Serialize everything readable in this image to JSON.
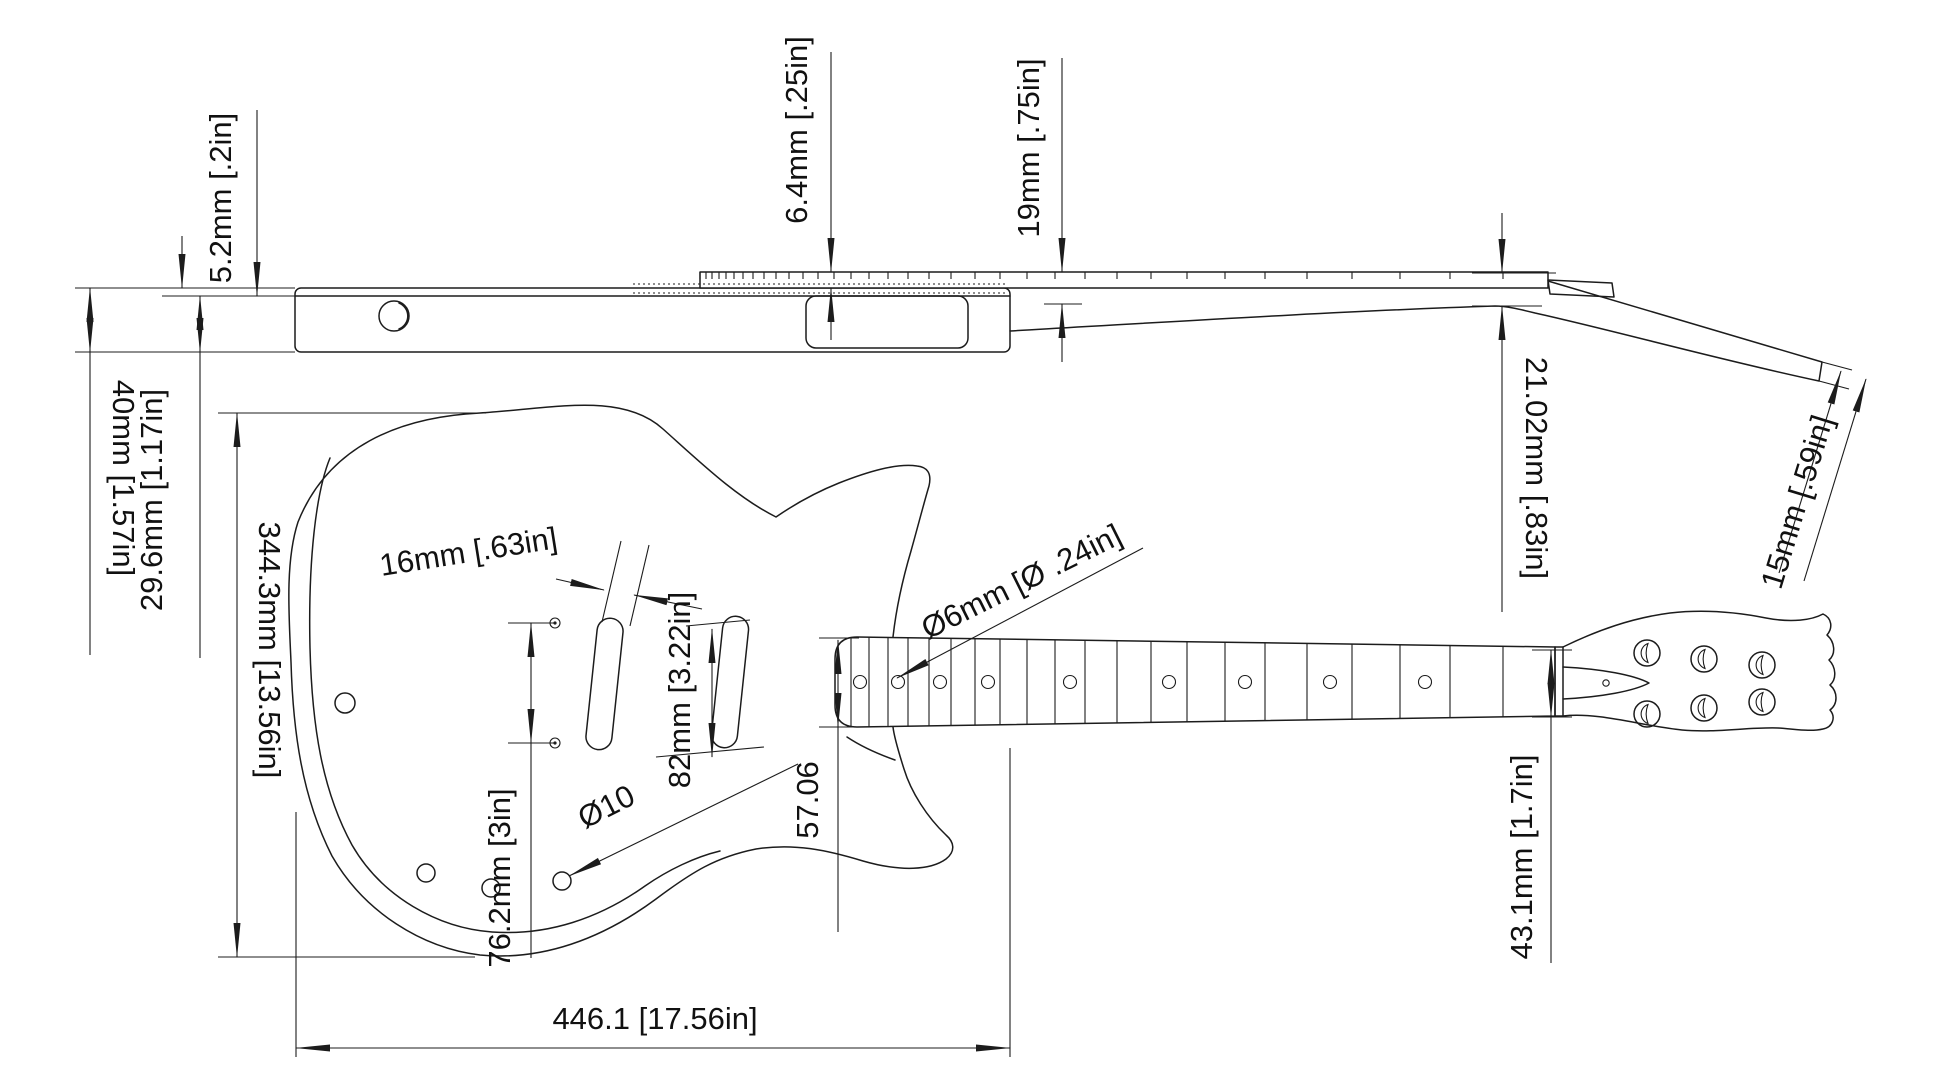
{
  "drawing": {
    "background": "#ffffff",
    "line_color": "#1c1c1c",
    "dimensions": {
      "laminate_thickness": "5.2mm [.2in]",
      "body_thickness": "40mm [1.57in]",
      "core_thickness": "29.6mm [1.17in]",
      "fretboard_thickness": "6.4mm [.25in]",
      "neck_thickness": "19mm [.75in]",
      "neck_heel_height": "21.02mm [.83in]",
      "headstock_thickness": "15mm [.59in]",
      "body_width": "344.3mm [13.56in]",
      "pickup_rout_width": "16mm [.63in]",
      "pickup_spacing": "82mm [3.22in]",
      "inlay_dot_diameter": "Ø6mm [Ø .24in]",
      "neck_heel_width": "57.06",
      "control_hole_diameter": "Ø10",
      "screw_spacing": "76.2mm [3in]",
      "body_length": "446.1 [17.56in]",
      "nut_width": "43.1mm [1.7in]"
    }
  }
}
